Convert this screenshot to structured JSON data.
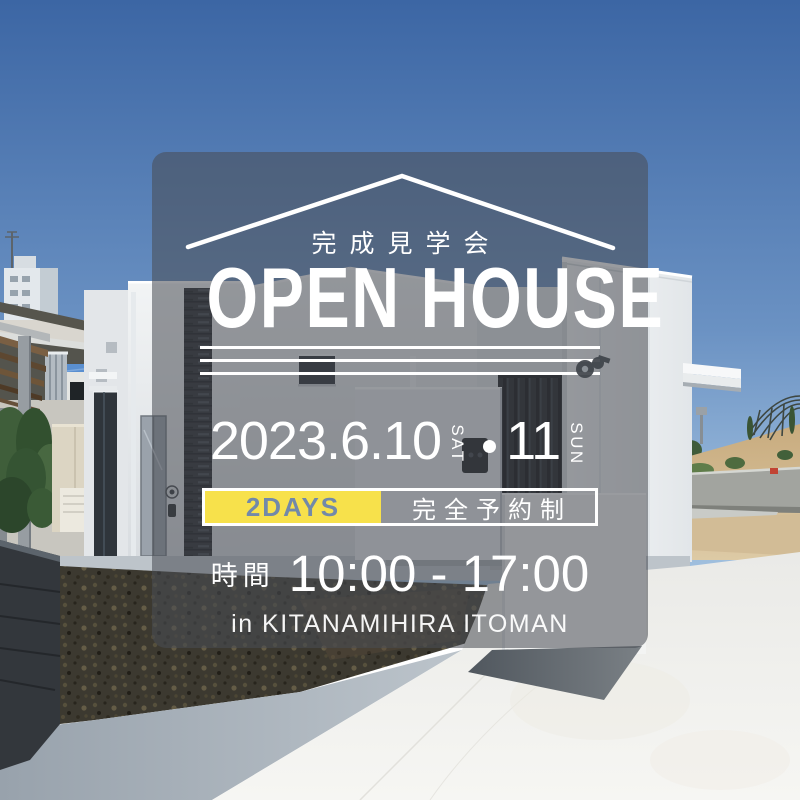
{
  "flyer": {
    "roof_label": "完成見学会",
    "title": "OPEN HOUSE",
    "date": {
      "main": "2023.6.10",
      "day1_dow": "SAT",
      "day2": "11",
      "day2_dow": "SUN"
    },
    "banner": {
      "days": "2DAYS",
      "reservation": "完全予約制"
    },
    "time": {
      "label": "時間",
      "value": "10:00 - 17:00"
    },
    "location": "in KITANAMIHIRA ITOMAN"
  },
  "colors": {
    "accent_yellow": "#F7E14B",
    "days_text": "#7289A9",
    "overlay_panel": "rgba(73,77,83,0.56)",
    "text_white": "#FFFFFF",
    "sky_top": "#3C66A4",
    "sky_horizon": "#9CBCDC"
  },
  "icons": {
    "roof_outline": "roof-chevron",
    "date_separator": "dot",
    "wall_fixture": "hose-reel"
  }
}
